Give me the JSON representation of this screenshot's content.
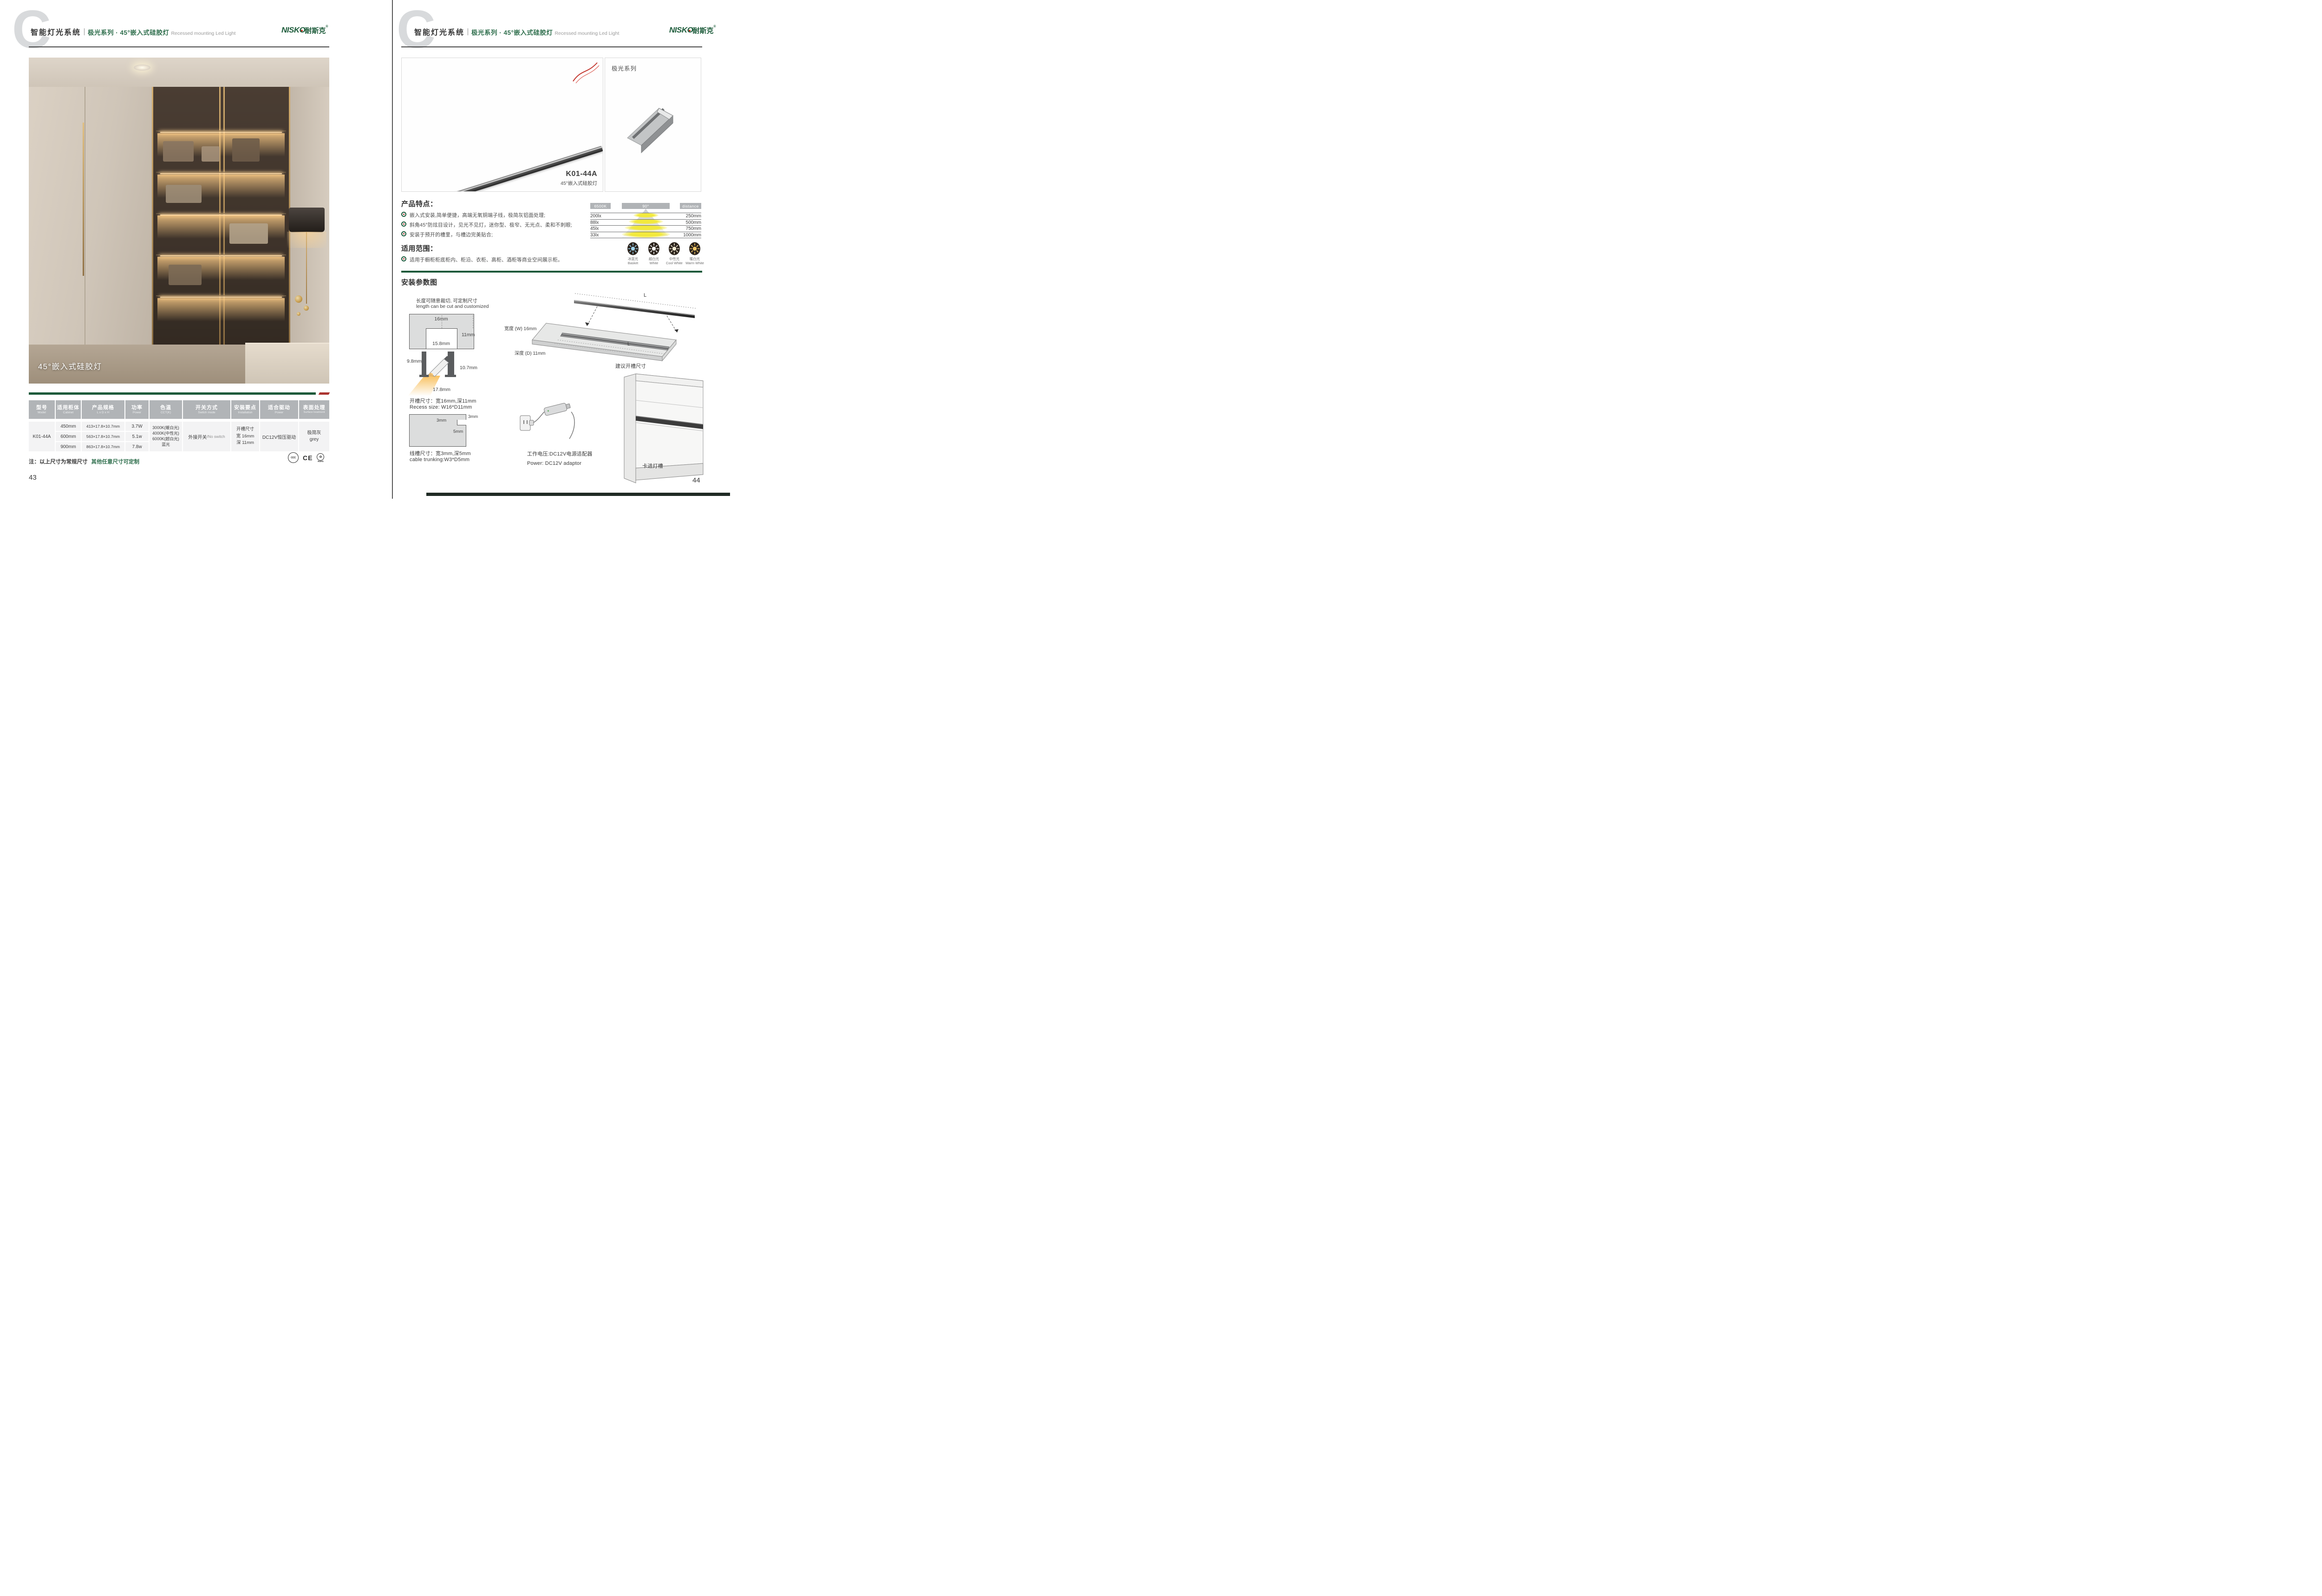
{
  "header": {
    "watermark": "C",
    "system_cn": "智能灯光系统",
    "series_cn": "极光系列 · 45°嵌入式硅胶灯",
    "series_en": "Recessed mounting Led Light",
    "brand_latin": "NISKO",
    "brand_cn": "耐斯克",
    "brand_reg": "®"
  },
  "left_page": {
    "photo_caption": "45°嵌入式硅胶灯",
    "table": {
      "headers": [
        {
          "cn": "型号",
          "en": "Model"
        },
        {
          "cn": "适用柜体",
          "en": "Cabinet"
        },
        {
          "cn": "产品规格",
          "en": "L x D x H"
        },
        {
          "cn": "功率",
          "en": "Power"
        },
        {
          "cn": "色温",
          "en": "CCT(K)"
        },
        {
          "cn": "开关方式",
          "en": "Switch mode"
        },
        {
          "cn": "安装要点",
          "en": "Installation"
        },
        {
          "cn": "适合驱动",
          "en": "Power"
        },
        {
          "cn": "表面处理",
          "en": "Surface treatment"
        }
      ],
      "model": "K01-44A",
      "variants": [
        {
          "cabinet": "450mm",
          "spec": "413×17.8×10.7mm",
          "power": "3.7W"
        },
        {
          "cabinet": "600mm",
          "spec": "563×17.8×10.7mm",
          "power": "5.1w"
        },
        {
          "cabinet": "900mm",
          "spec": "863×17.8×10.7mm",
          "power": "7.8w"
        }
      ],
      "cct": [
        "3000K(暖白光)",
        "4000K(中性光)",
        "6000K(超白光)",
        "蓝光"
      ],
      "switch_cn": "外接开关",
      "switch_en": "/No switch",
      "installation": [
        "开槽尺寸",
        "宽 16mm",
        "深 11mm"
      ],
      "driver": "DC12V恒压驱动",
      "surface_cn": "极简灰",
      "surface_en": "grey"
    },
    "note_main": "注：以上尺寸为常规尺寸",
    "note_green": "其他任意尺寸可定制",
    "certs": {
      "ccc": "CCC",
      "ce": "CE",
      "rohs": "RoHS",
      "rohs_glyph": "✿"
    },
    "page_number": "43"
  },
  "right_page": {
    "gallery": {
      "model": "K01-44A",
      "name": "45°嵌入式硅胶灯",
      "series_label": "极光系列"
    },
    "features": {
      "title": "产品特点：",
      "items": [
        "嵌入式安装,简单便捷，高端无氧铜端子线，极简灰铝面处理;",
        "斜角45°防炫目设计，见光不见灯，迷你型、极窄、无光点、柔和不刺眼;",
        "安装于预开的槽里，与槽边完美贴合;"
      ]
    },
    "beam_chart": {
      "type": "table",
      "cct": "6500K",
      "angle": "90°",
      "distance_label": "distance",
      "rows": [
        {
          "lux": "200lx",
          "distance": "250mm"
        },
        {
          "lux": "88lx",
          "distance": "500mm"
        },
        {
          "lux": "45lx",
          "distance": "750mm"
        },
        {
          "lux": "33lx",
          "distance": "1000mm"
        }
      ]
    },
    "cct_icons": [
      {
        "cn": "冰蓝光",
        "en": "Basket",
        "color": "#9fd4ee"
      },
      {
        "cn": "超白光",
        "en": "White",
        "color": "#ffffff"
      },
      {
        "cn": "中性光",
        "en": "Cool White",
        "color": "#f6ecd4"
      },
      {
        "cn": "暖白光",
        "en": "Warm White",
        "color": "#f2c868"
      }
    ],
    "scope": {
      "title": "适用范围：",
      "items": [
        "适用于橱柜柜底柜内、柜沿、衣柜、高柜、酒柜等商业空间展示柜。"
      ]
    },
    "install": {
      "title": "安装参数图",
      "cut_note_cn": "长度可随意裁切, 可定制尺寸",
      "cut_note_en": "length can be cut and customized",
      "recess": {
        "top": "16mm",
        "depth": "11mm",
        "inner": "15.8mm"
      },
      "profile": {
        "left": "9.8mm",
        "right": "10.7mm",
        "bottom": "17.8mm"
      },
      "recess_text_cn": "开槽尺寸：宽16mm,深11mm",
      "recess_text_en": "Recess size: W16*D11mm",
      "trunking": {
        "notch_w": "3mm",
        "notch_side": "3mm",
        "depth": "5mm"
      },
      "trunking_text_cn": "线槽尺寸：宽3mm,深5mm",
      "trunking_text_en": "cable trunking:W3*D5mm",
      "board": {
        "width_label": "宽度 (W) 16mm",
        "depth_label": "深度 (D) 11mm",
        "length_label": "L",
        "length_label2": "L",
        "caption": "建议开槽尺寸"
      },
      "power_cn": "工作电压:DC12V电源适配器",
      "power_en": "Power: DC12V adaptor",
      "clip_label": "卡进灯槽"
    },
    "page_number": "44"
  }
}
